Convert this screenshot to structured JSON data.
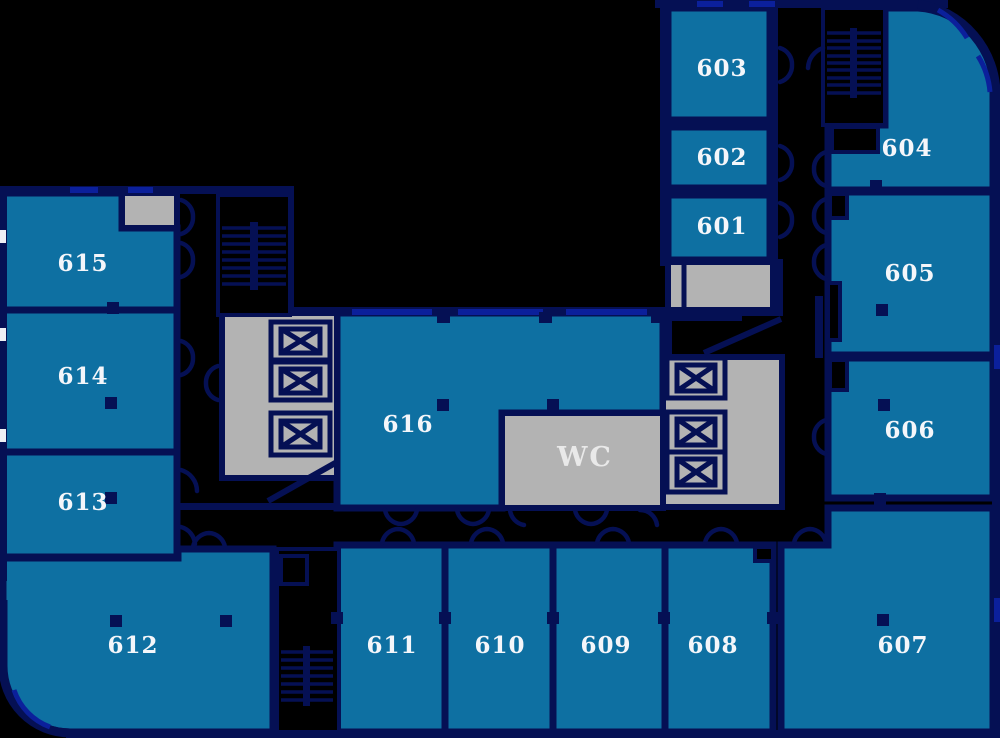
{
  "plan": {
    "name": "office-floor-plan-level-6",
    "colors": {
      "background": "#000000",
      "wall": "#051054",
      "window_accent": "#0b209b",
      "room_fill": "#0e70a2",
      "service_fill": "#b3b3b3",
      "label_text": "#f4f6fa"
    },
    "rooms": {
      "r601": "601",
      "r602": "602",
      "r603": "603",
      "r604": "604",
      "r605": "605",
      "r606": "606",
      "r607": "607",
      "r608": "608",
      "r609": "609",
      "r610": "610",
      "r611": "611",
      "r612": "612",
      "r613": "613",
      "r614": "614",
      "r615": "615",
      "r616": "616",
      "wc": "WC"
    },
    "features": {
      "stairwells": 3,
      "elevator_shafts": 6
    }
  }
}
